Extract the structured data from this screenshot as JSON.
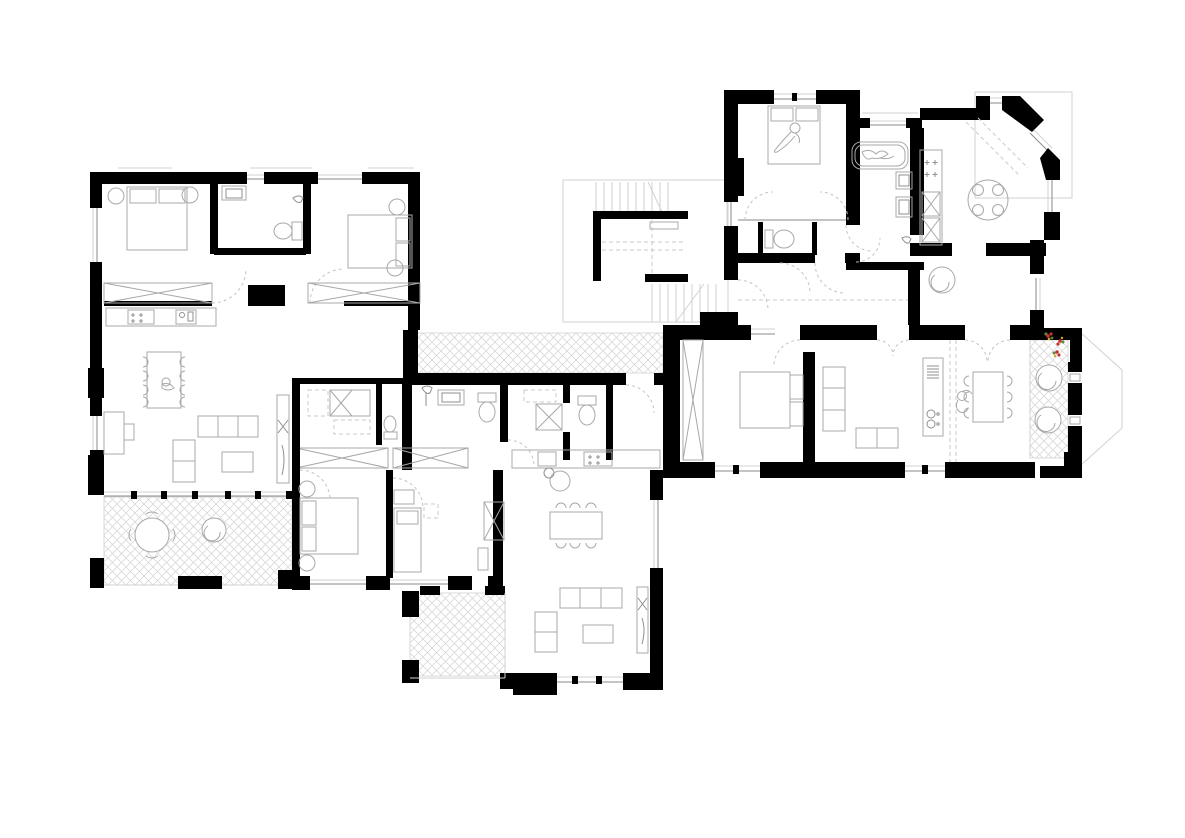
{
  "document": {
    "type": "architectural-floor-plan",
    "view": "top-down-plan",
    "text_labels": [],
    "units": [
      {
        "id": "apartment-west",
        "icons": [
          "double-bed",
          "double-bed",
          "bathroom-sink",
          "toilet",
          "wardrobe",
          "kitchen-counter",
          "stove",
          "kitchen-sink",
          "dining-table-8-chairs",
          "desk",
          "sofa",
          "loveseat",
          "coffee-table",
          "shelf",
          "terrace-round-table",
          "lounge-chair",
          "terrace-hatch"
        ]
      },
      {
        "id": "apartment-south",
        "icons": [
          "double-bed",
          "single-bed",
          "wardrobe",
          "shower",
          "bathroom-sink",
          "toilet",
          "toilet",
          "kitchen-counter",
          "stove",
          "kitchen-sink",
          "dining-table-6-chairs",
          "sofa",
          "loveseat",
          "coffee-table",
          "shelf",
          "balcony-hatch",
          "walkway-hatch"
        ]
      },
      {
        "id": "stairwell",
        "icons": [
          "stair-flight-up",
          "stair-landing",
          "stair-flight-down"
        ]
      },
      {
        "id": "apartment-north",
        "icons": [
          "double-bed",
          "person-lying",
          "toilet",
          "bathtub",
          "person-bathing",
          "bathroom-sink",
          "bathroom-sink",
          "shower-head",
          "kitchen-counter",
          "stove",
          "round-table-4-stools",
          "bay-window",
          "round-chair"
        ]
      },
      {
        "id": "apartment-east",
        "icons": [
          "wardrobe",
          "double-bed",
          "sofa",
          "loveseat",
          "kitchen-island",
          "island-sink",
          "dining-table-6-chairs",
          "person-sitting",
          "winter-garden-hatch",
          "lounge-chair",
          "lounge-chair",
          "flower-plants",
          "bay-outline"
        ]
      }
    ]
  },
  "colors": {
    "wall": "#000000",
    "background": "#ffffff",
    "furniture_stroke": "#a8a8a8",
    "furniture_dark": "#8f8f8f",
    "dashed_line": "#c9c9c9",
    "door_swing": "#c4c4c4",
    "window_line": "#8a8a8a",
    "roof_outline": "#d2d2d2",
    "hatch": "#d9d9d9",
    "flower_red": "#c5342b",
    "flower_green": "#5d8a3c",
    "flower_yellow": "#d9a418"
  },
  "canvas": {
    "width": 1185,
    "height": 838
  }
}
